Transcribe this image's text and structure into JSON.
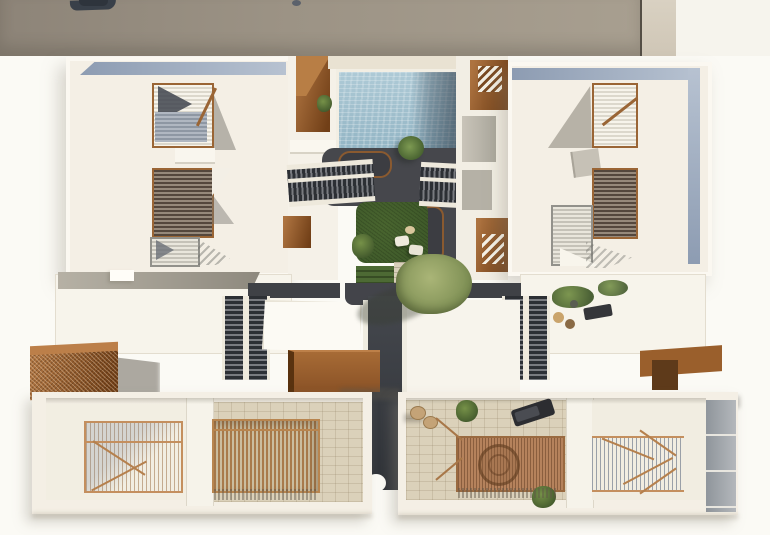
{
  "scene": {
    "description": "Aerial top-down 3D architectural render of a residential complex: two upper apartment blocks with louvered corten skylights flank a central courtyard containing a swimming pool, charcoal deck, lawn with seating and an olive tree; twin staircases and corten steel entrance canopies lead down to two lower houses with timber-slat pergola patios; a neighboring grey roof crosses the top edge.",
    "objects": [
      "neighbor-roof",
      "rooftop-unit",
      "upper-block-left",
      "upper-block-right",
      "louvered-skylights",
      "swimming-pool",
      "charcoal-deck",
      "planters",
      "lawn",
      "garden-seating",
      "olive-tree",
      "palm",
      "courtyard-stairs",
      "double-stairs",
      "corten-canopies",
      "central-alley",
      "lower-house-left",
      "lower-house-right",
      "timber-pergolas",
      "patio-furniture",
      "sun-lounger",
      "hanging-chair"
    ]
  },
  "colors": {
    "ground": "#fbfaf5",
    "roof": "#f4efe5",
    "parapet": "#fbf8f1",
    "neighbor-roof-dark": "#8d8478",
    "neighbor-roof-light": "#a89f90",
    "neighbor-wall": "#d9d1c2",
    "band-blue-dark": "#8d9cb2",
    "band-blue-light": "#b7c2d1",
    "corten-light": "#ad7340",
    "corten-dark": "#713f17",
    "corten-frame": "#9a6535",
    "wood": "#c48f5e",
    "wood-deck": "#b5825c",
    "pool-light": "#aecad6",
    "pool-mid": "#8fb2c2",
    "pool-shadow": "#3f4e5c",
    "charcoal": "#46474c",
    "lawn": "#3f5a2a",
    "tree": "#a8b477",
    "tread-dark": "#2c2f34",
    "tread-light": "#797b80",
    "paver": "#dbd1ba",
    "shadow-soft": "rgba(145,140,125,0.35)"
  }
}
